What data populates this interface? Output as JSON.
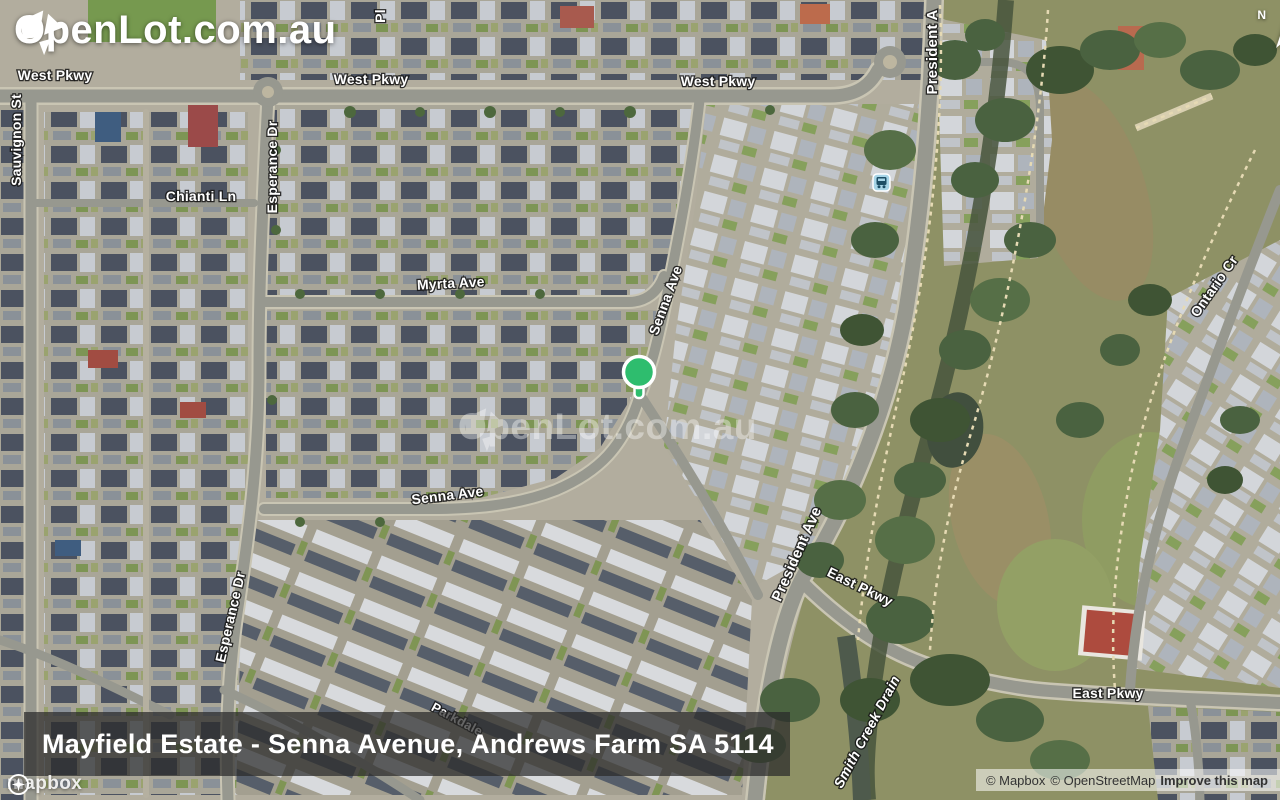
{
  "brand": {
    "logo_text": "OpenLot.com.au",
    "watermark_text": "OpenLot.com.au"
  },
  "compass": {
    "label": "N"
  },
  "map": {
    "caption": "Mayfield Estate - Senna Avenue, Andrews Farm SA 5114",
    "marker": {
      "color": "#2ebd6e"
    },
    "street_labels": [
      {
        "text": "West Pkwy"
      },
      {
        "text": "West Pkwy"
      },
      {
        "text": "West Pkwy"
      },
      {
        "text": "Pl"
      },
      {
        "text": "Sauvignon St"
      },
      {
        "text": "Chianti Ln"
      },
      {
        "text": "Esperance Dr"
      },
      {
        "text": "Myrta Ave"
      },
      {
        "text": "Senna Ave"
      },
      {
        "text": "Senna Ave"
      },
      {
        "text": "Esperance Dr"
      },
      {
        "text": "President A"
      },
      {
        "text": "President Ave"
      },
      {
        "text": "East Pkwy"
      },
      {
        "text": "East Pkwy"
      },
      {
        "text": "Ontario Cr"
      },
      {
        "text": "Smith Creek Drain"
      },
      {
        "text": "Parkdale"
      }
    ]
  },
  "attribution": {
    "mapbox_wordmark": "mapbox",
    "mapbox": "© Mapbox",
    "osm": "© OpenStreetMap",
    "improve": "Improve this map"
  }
}
